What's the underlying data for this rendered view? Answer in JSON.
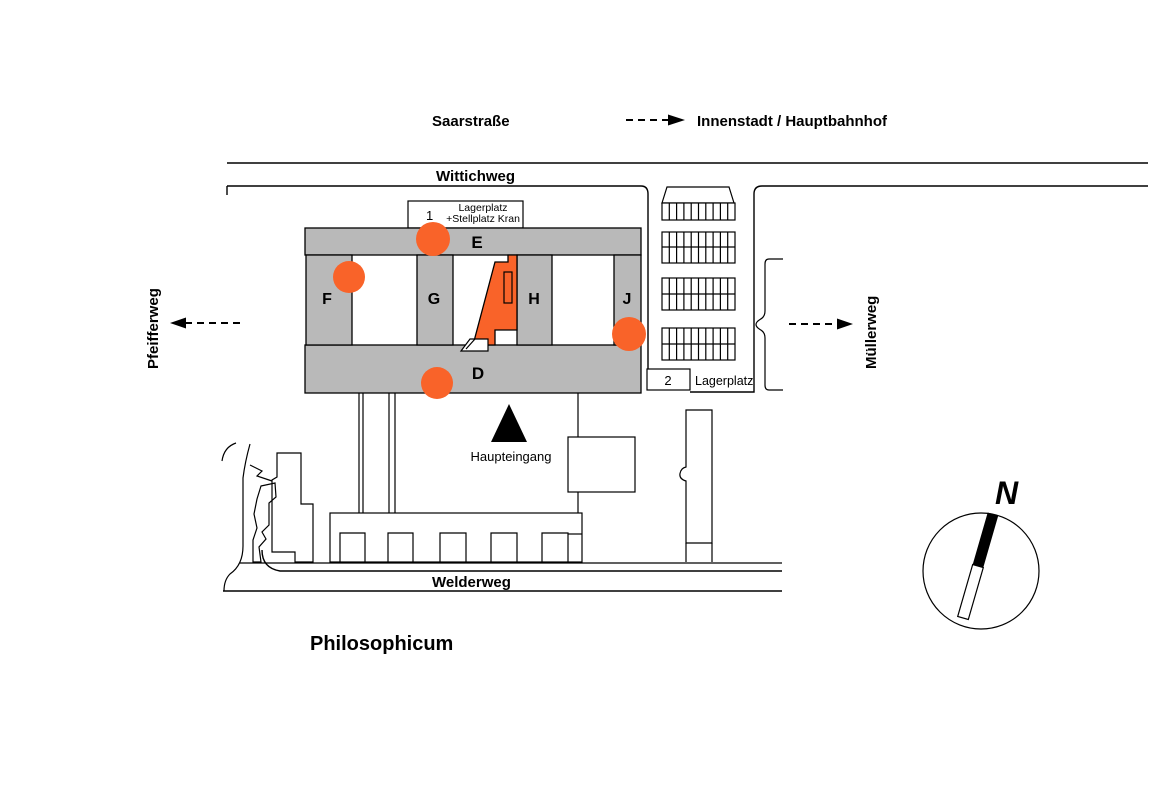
{
  "colors": {
    "orange": "#F96329",
    "gray": "#B9B9B9"
  },
  "title": "Philosophicum",
  "streets": {
    "top": "Saarstraße",
    "upper": "Wittichweg",
    "lower": "Welderweg",
    "left": "Pfeifferweg",
    "right": "Müllerweg"
  },
  "destination_label": "Innenstadt / Hauptbahnhof",
  "entrance_label": "Haupteingang",
  "wings": {
    "e": "E",
    "f": "F",
    "g": "G",
    "h": "H",
    "j": "J",
    "d": "D"
  },
  "storage1": {
    "num": "1",
    "line1": "Lagerplatz",
    "line2": "+Stellplatz Kran"
  },
  "storage2": {
    "num": "2",
    "label": "Lagerplatz"
  },
  "compass": {
    "north": "N"
  }
}
